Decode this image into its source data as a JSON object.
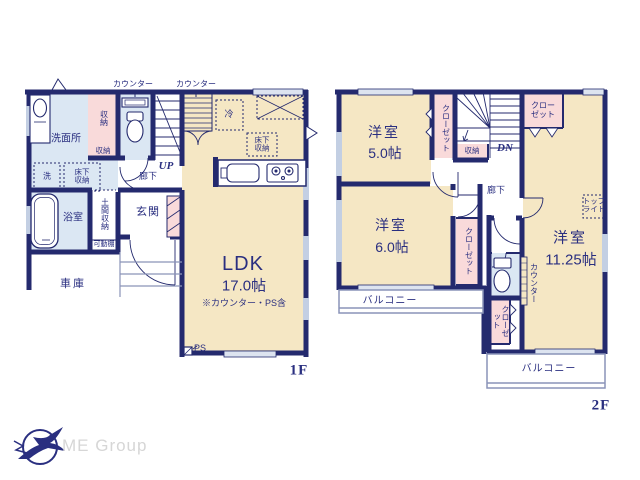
{
  "colors": {
    "wall": "#242a6e",
    "text": "#2a2f80",
    "room_tan": "#f5e7c4",
    "wet_blue": "#dbe7f3",
    "closet_pink": "#f9dada",
    "window": "#c3cfe3",
    "rail": "#8a93b8",
    "logo_gray": "#d6d6d6"
  },
  "floor1": {
    "tag": "1F",
    "labels": {
      "counter_a": "カウンター",
      "counter_b": "カウンター",
      "washroom": "洗面所",
      "storage_tall": "収納",
      "storage_small": "収納",
      "washer": "洗",
      "underfloor_a": "床下収納",
      "up": "UP",
      "hallway": "廊下",
      "bathroom": "浴室",
      "doma_storage": "土間収納",
      "movable_shelf": "可動棚",
      "entrance": "玄関",
      "garage": "車庫",
      "fridge": "冷",
      "underfloor_b": "床下収納",
      "ps": "PS"
    },
    "ldk": {
      "name": "LDK",
      "size": "17.0帖",
      "note": "※カウンター・PS含"
    }
  },
  "floor2": {
    "tag": "2F",
    "labels": {
      "closet_a": "クローゼット",
      "storage": "収納",
      "dn": "DN",
      "closet_b": "クローゼット",
      "hallway": "廊下",
      "skylight": "トップライト",
      "closet_c": "クローゼット",
      "counter": "カウンター",
      "closet_d": "クローゼット",
      "balcony_a": "バルコニー",
      "balcony_b": "バルコニー"
    },
    "rooms": {
      "west_a": {
        "name": "洋室",
        "size": "5.0帖"
      },
      "west_b": {
        "name": "洋室",
        "size": "6.0帖"
      },
      "west_c": {
        "name": "洋室",
        "size": "11.25帖"
      }
    }
  },
  "logo": {
    "text": "ME Group"
  }
}
